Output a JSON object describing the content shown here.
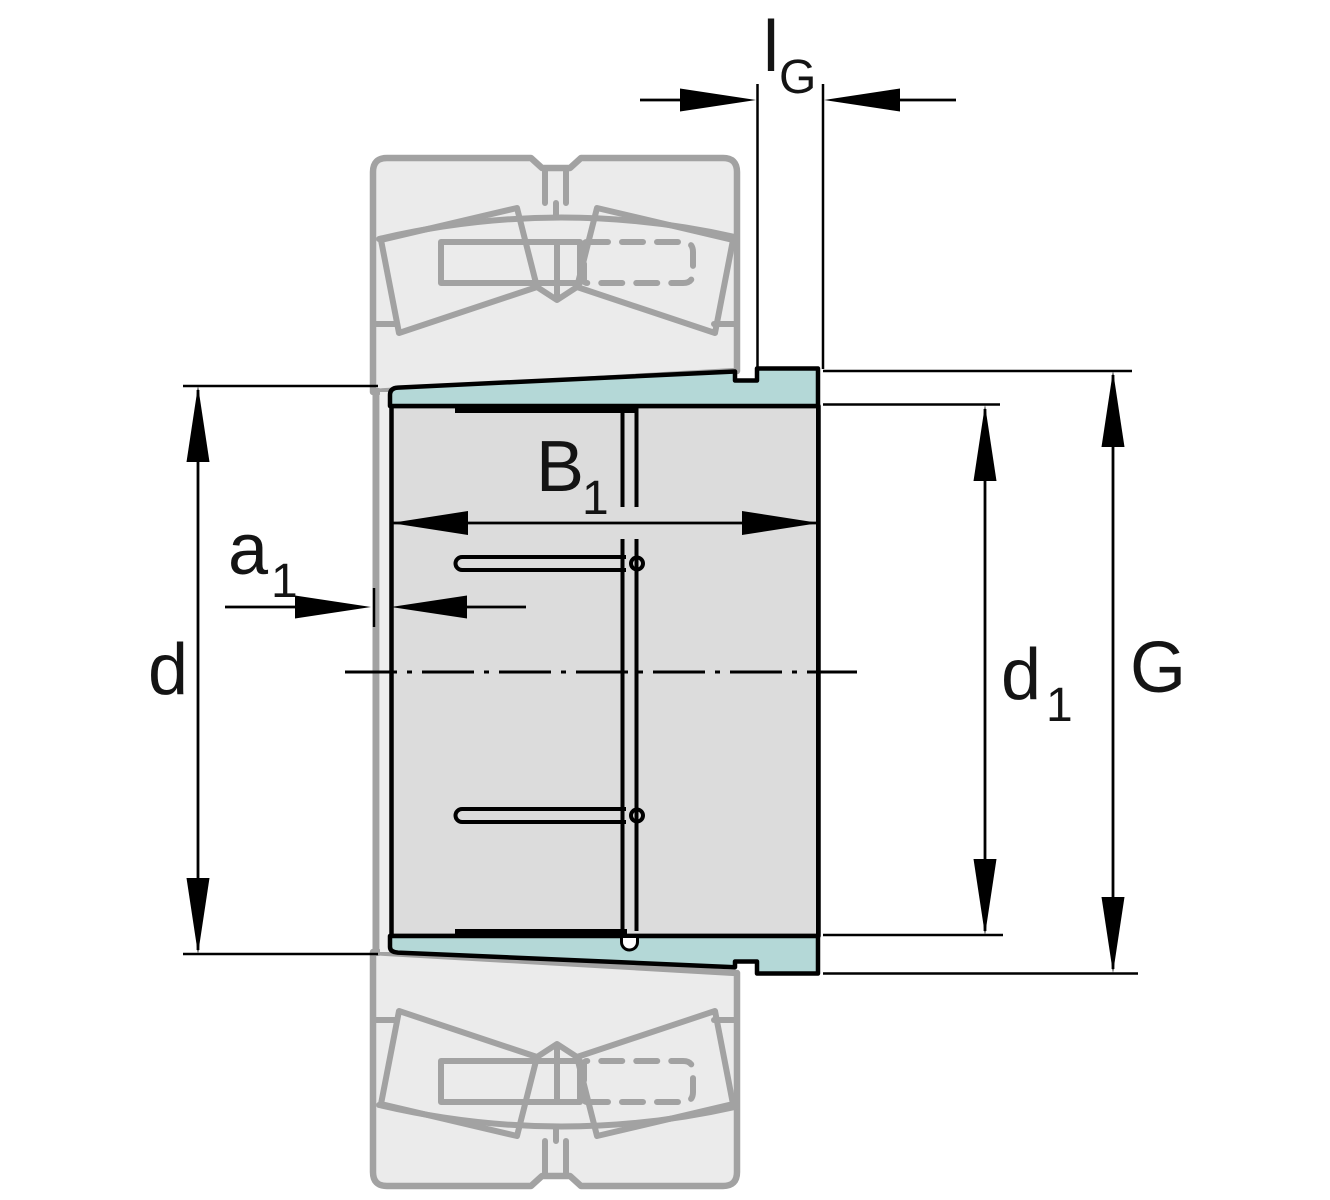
{
  "figure": {
    "type": "technical-drawing",
    "subject": "adapter-sleeve-with-spherical-roller-bearing",
    "labels": {
      "lG": {
        "main": "l",
        "sub": "G"
      },
      "B1": {
        "main": "B",
        "sub": "1"
      },
      "a1": {
        "main": "a",
        "sub": "1"
      },
      "d": {
        "main": "d"
      },
      "d1": {
        "main": "d",
        "sub": "1"
      },
      "G": {
        "main": "G"
      }
    },
    "colors": {
      "sleeve_taper_surface": "#b4d8d7",
      "sleeve_body": "#dcdcdc",
      "bearing_fill": "#ebebeb",
      "bearing_outline": "#a2a2a2",
      "line": "#000000",
      "background": "#ffffff"
    }
  }
}
